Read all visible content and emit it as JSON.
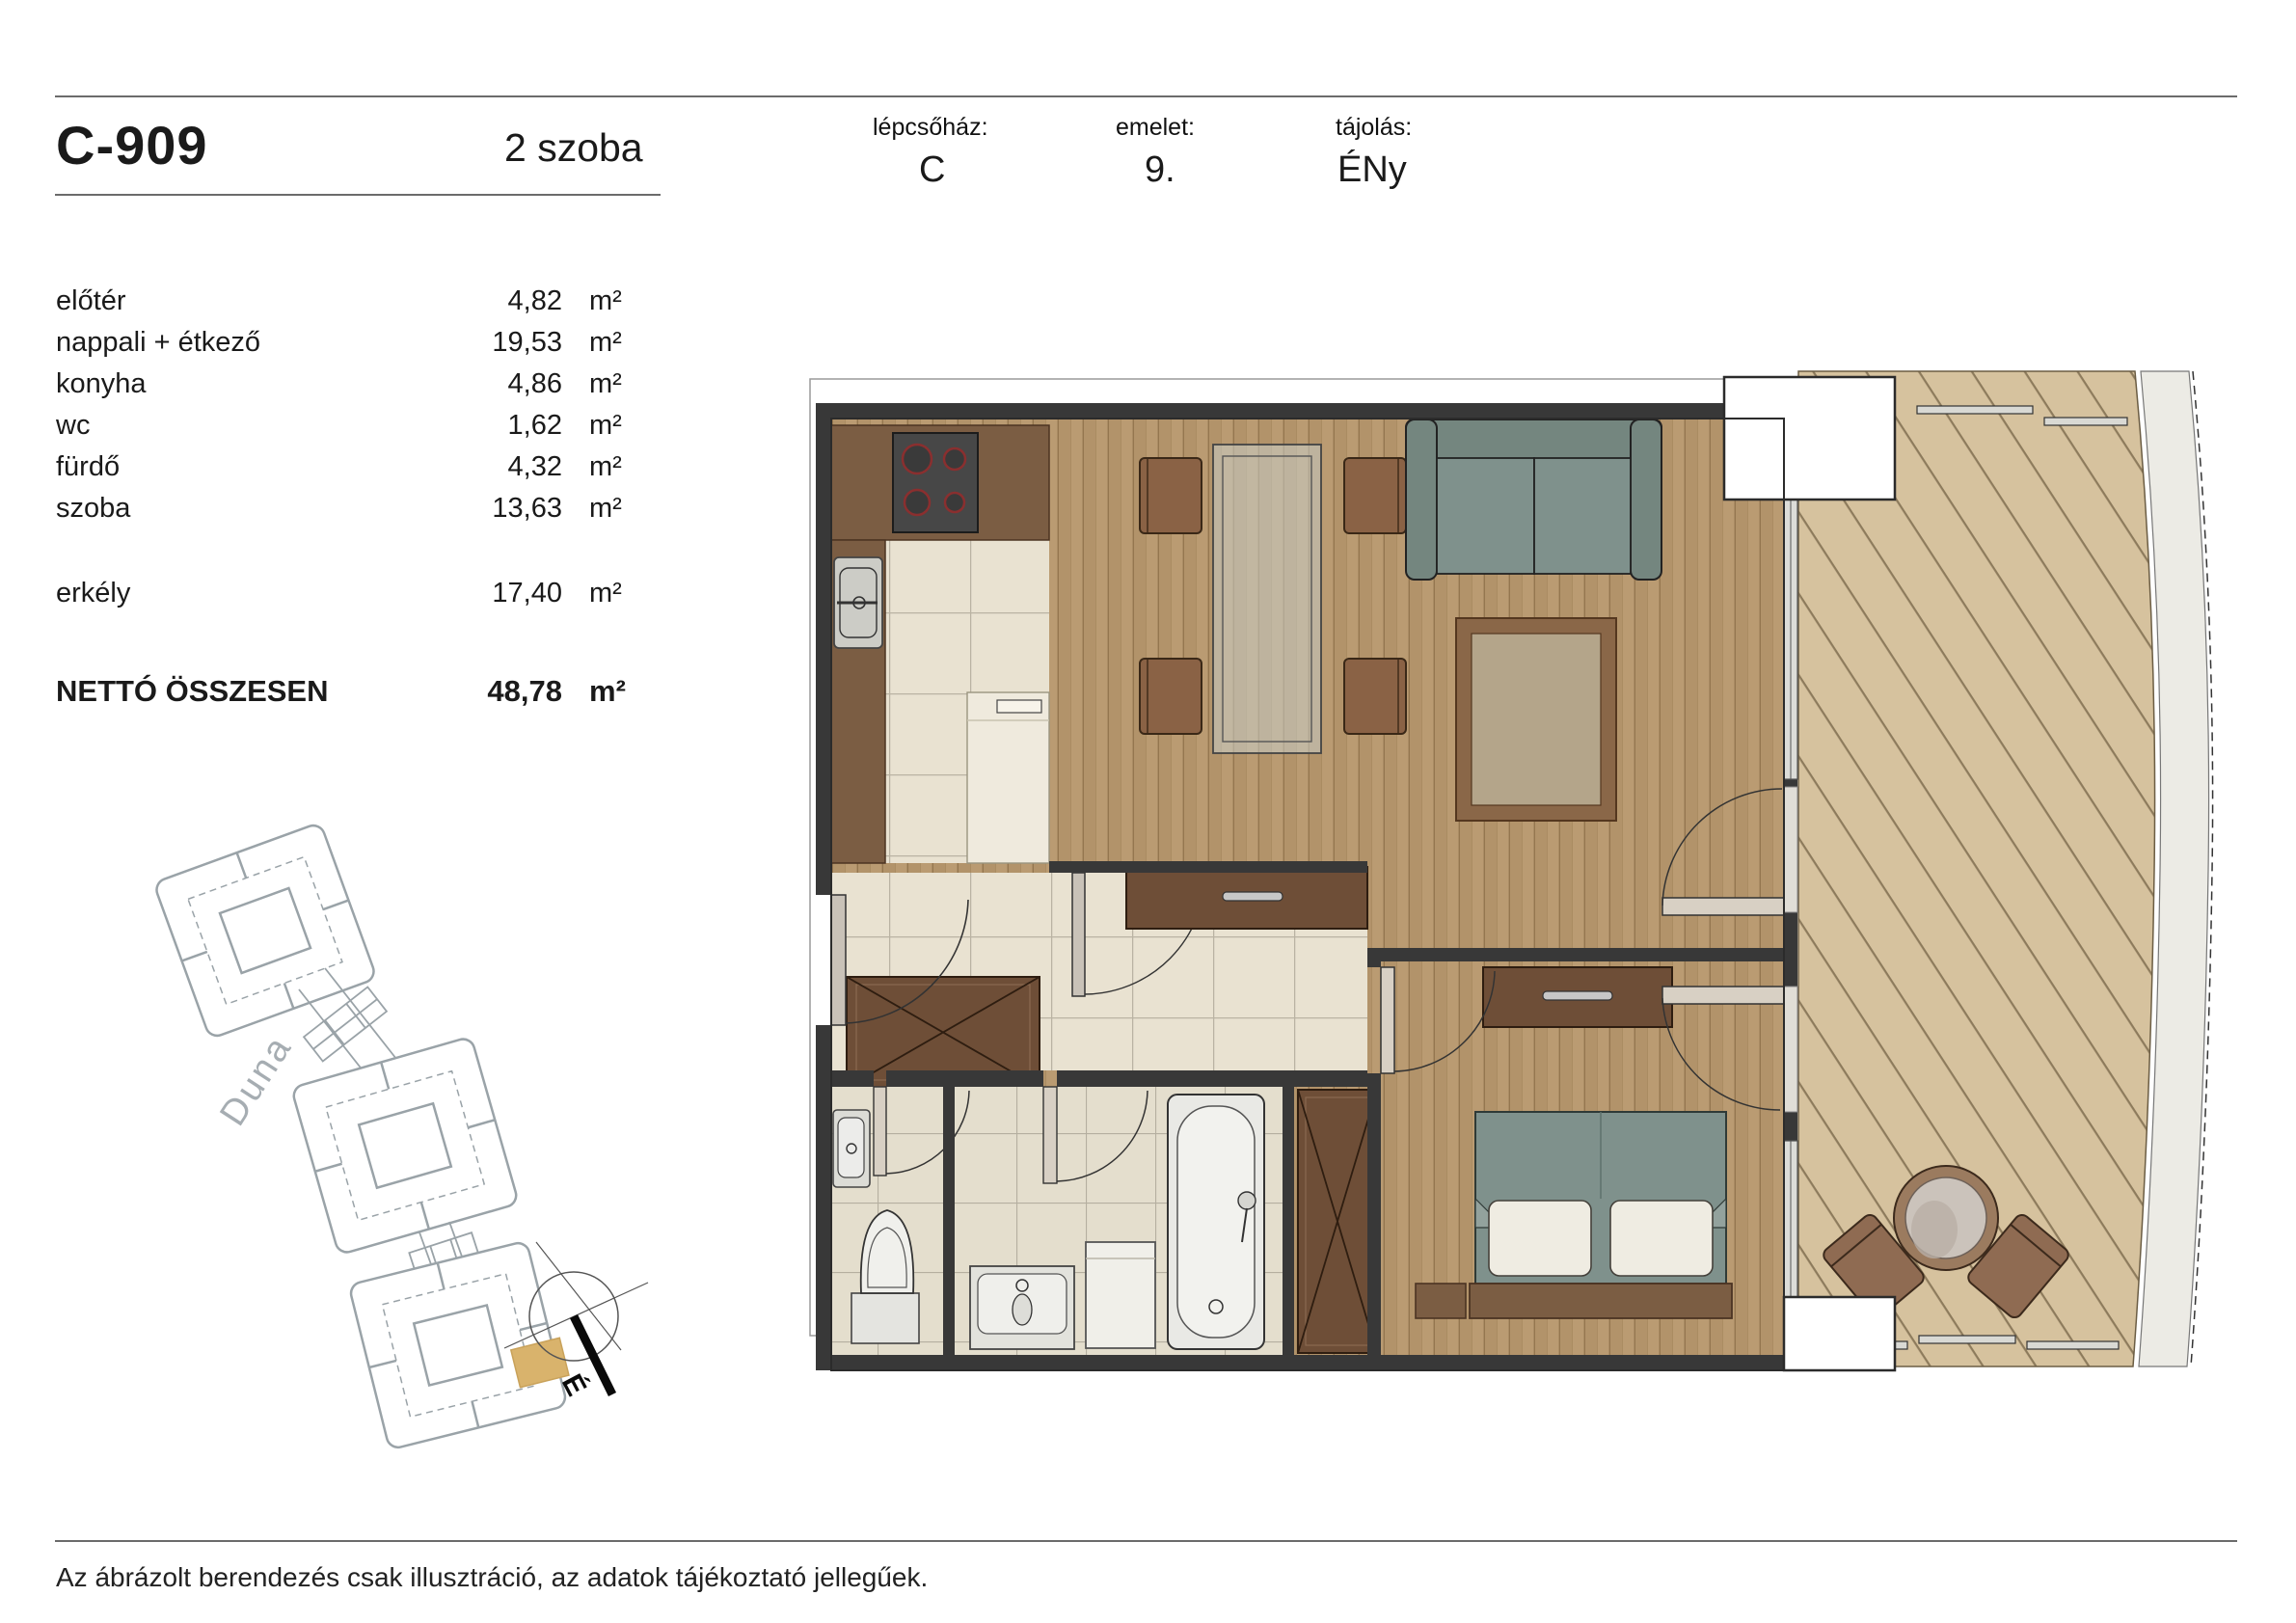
{
  "header": {
    "unit_id": "C-909",
    "unit_type": "2 szoba",
    "fields": [
      {
        "label": "lépcsőház:",
        "value": "C"
      },
      {
        "label": "emelet:",
        "value": "9."
      },
      {
        "label": "tájolás:",
        "value": "ÉNy"
      }
    ]
  },
  "areas": {
    "rows": [
      {
        "name": "előtér",
        "value": "4,82",
        "unit": "m²"
      },
      {
        "name": "nappali + étkező",
        "value": "19,53",
        "unit": "m²"
      },
      {
        "name": "konyha",
        "value": "4,86",
        "unit": "m²"
      },
      {
        "name": "wc",
        "value": "1,62",
        "unit": "m²"
      },
      {
        "name": "fürdő",
        "value": "4,32",
        "unit": "m²"
      },
      {
        "name": "szoba",
        "value": "13,63",
        "unit": "m²"
      }
    ],
    "balcony_row": {
      "name": "erkély",
      "value": "17,40",
      "unit": "m²"
    },
    "total": {
      "name": "NETTÓ ÖSSZESEN",
      "value": "48,78",
      "unit": "m²"
    }
  },
  "site_map": {
    "river_label": "Duna",
    "compass_label": "É",
    "highlight_color": "#d9b36c"
  },
  "floor_plan_colors": {
    "wood_floor": "#b2936a",
    "balcony_deck": "#d6c29e",
    "tile": "#e9e2d1",
    "counter_wood": "#7b5d43",
    "dark_furniture": "#6e4e37",
    "sofa_textile": "#7f918c",
    "wall": "#383838",
    "facade": "#ecebe5"
  },
  "footer": {
    "disclaimer": "Az ábrázolt berendezés csak illusztráció, az adatok tájékoztató jellegűek."
  }
}
